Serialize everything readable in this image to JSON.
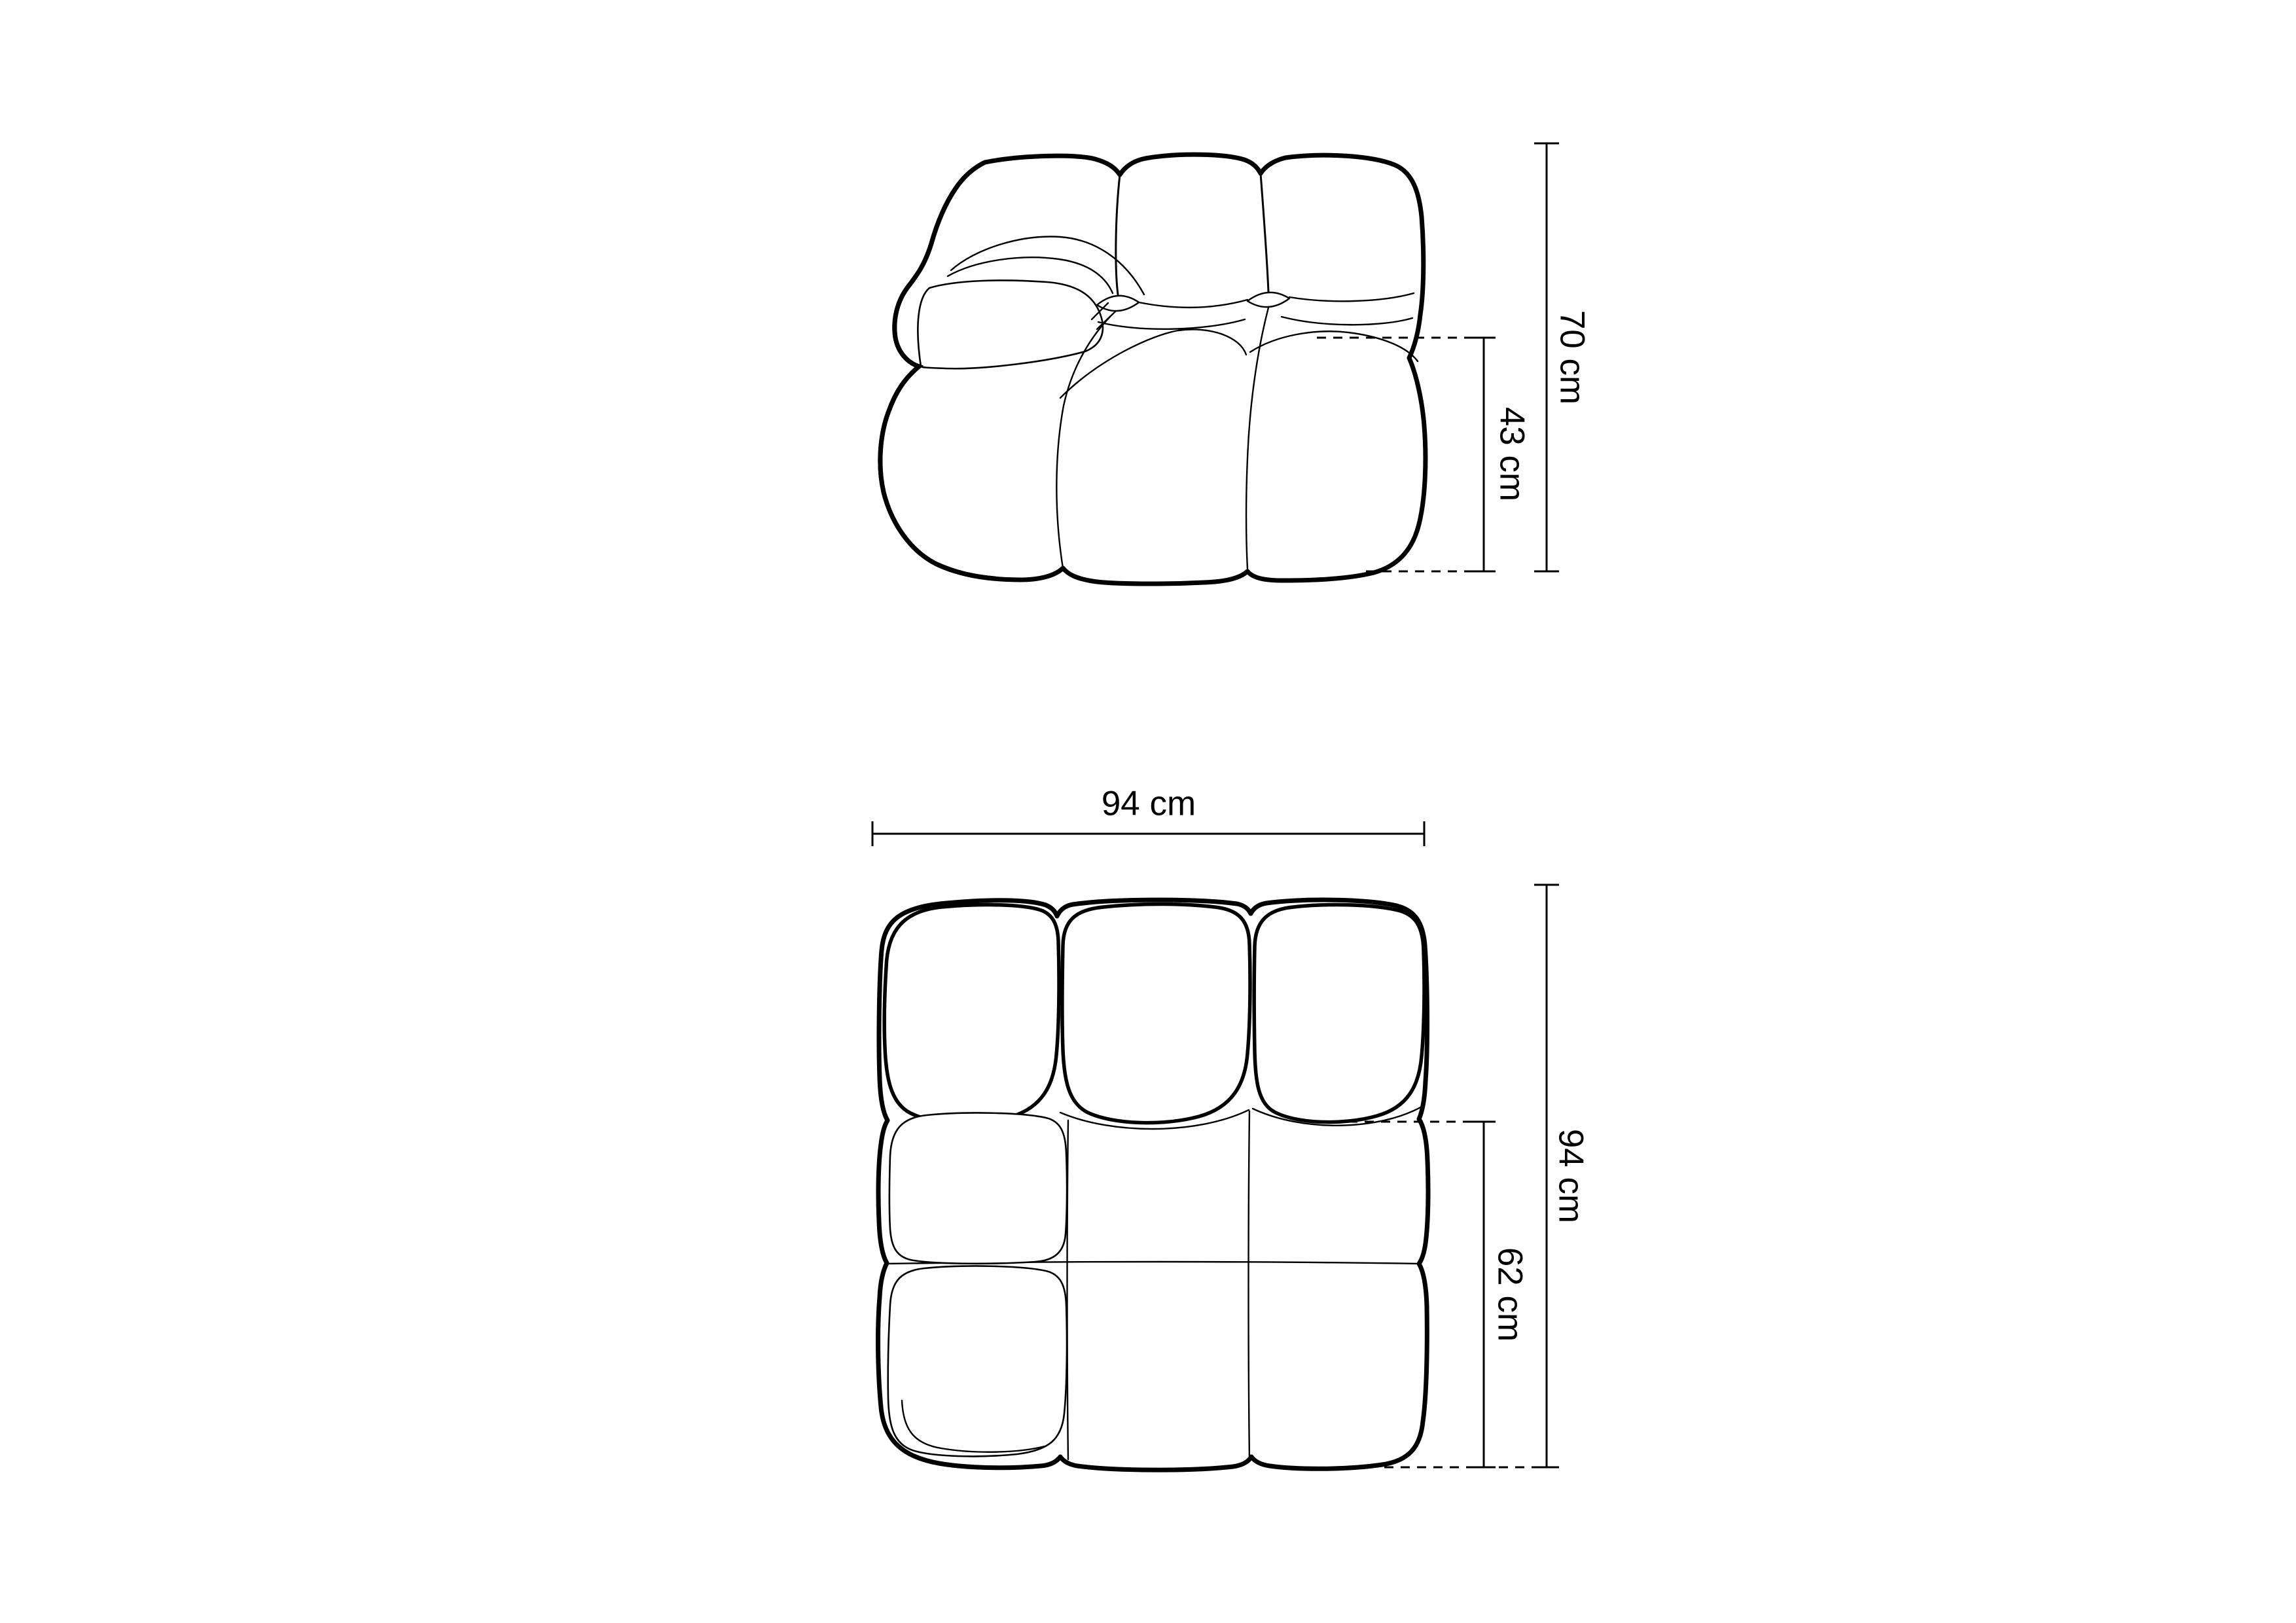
{
  "page": {
    "background": "#ffffff",
    "ink_color": "#000000"
  },
  "side_view": {
    "name": "sofa module side elevation",
    "dims": {
      "total_height": "70 cm",
      "seat_height": "43 cm"
    }
  },
  "top_view": {
    "name": "sofa module top plan",
    "dims": {
      "width": "94 cm",
      "total_depth": "94 cm",
      "seat_depth": "62 cm"
    }
  }
}
